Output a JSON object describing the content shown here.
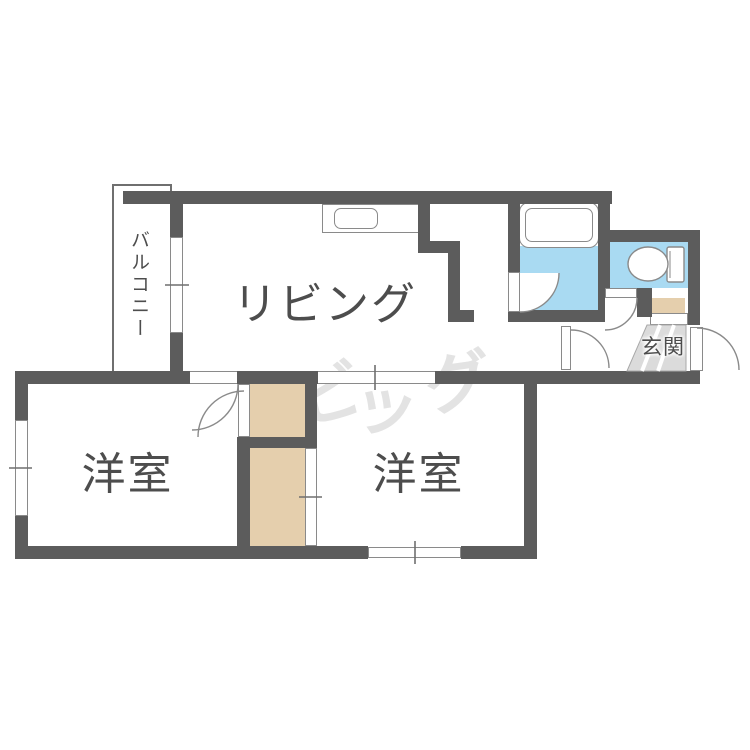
{
  "rooms": {
    "living": {
      "label": "リビング"
    },
    "bedroom_left": {
      "label": "洋室"
    },
    "bedroom_right": {
      "label": "洋室"
    },
    "balcony": {
      "label": "バルコニー"
    },
    "entrance": {
      "label": "玄関"
    }
  },
  "watermark": {
    "text": "ビッグ",
    "chars": [
      "ビ",
      "ッ",
      "グ"
    ]
  },
  "icons": {
    "bathtub": "bathtub-icon",
    "toilet": "toilet-icon",
    "kitchen_sink": "kitchen-sink-icon"
  },
  "colors": {
    "wall": "#5c5c5c",
    "water_blue": "#a9daf2",
    "closet_beige": "#e5cfad",
    "entrance_gray": "#dbdbdb",
    "outline": "#8a8a8a",
    "text": "#4d4d4d",
    "watermark": "#e3e3e3"
  }
}
